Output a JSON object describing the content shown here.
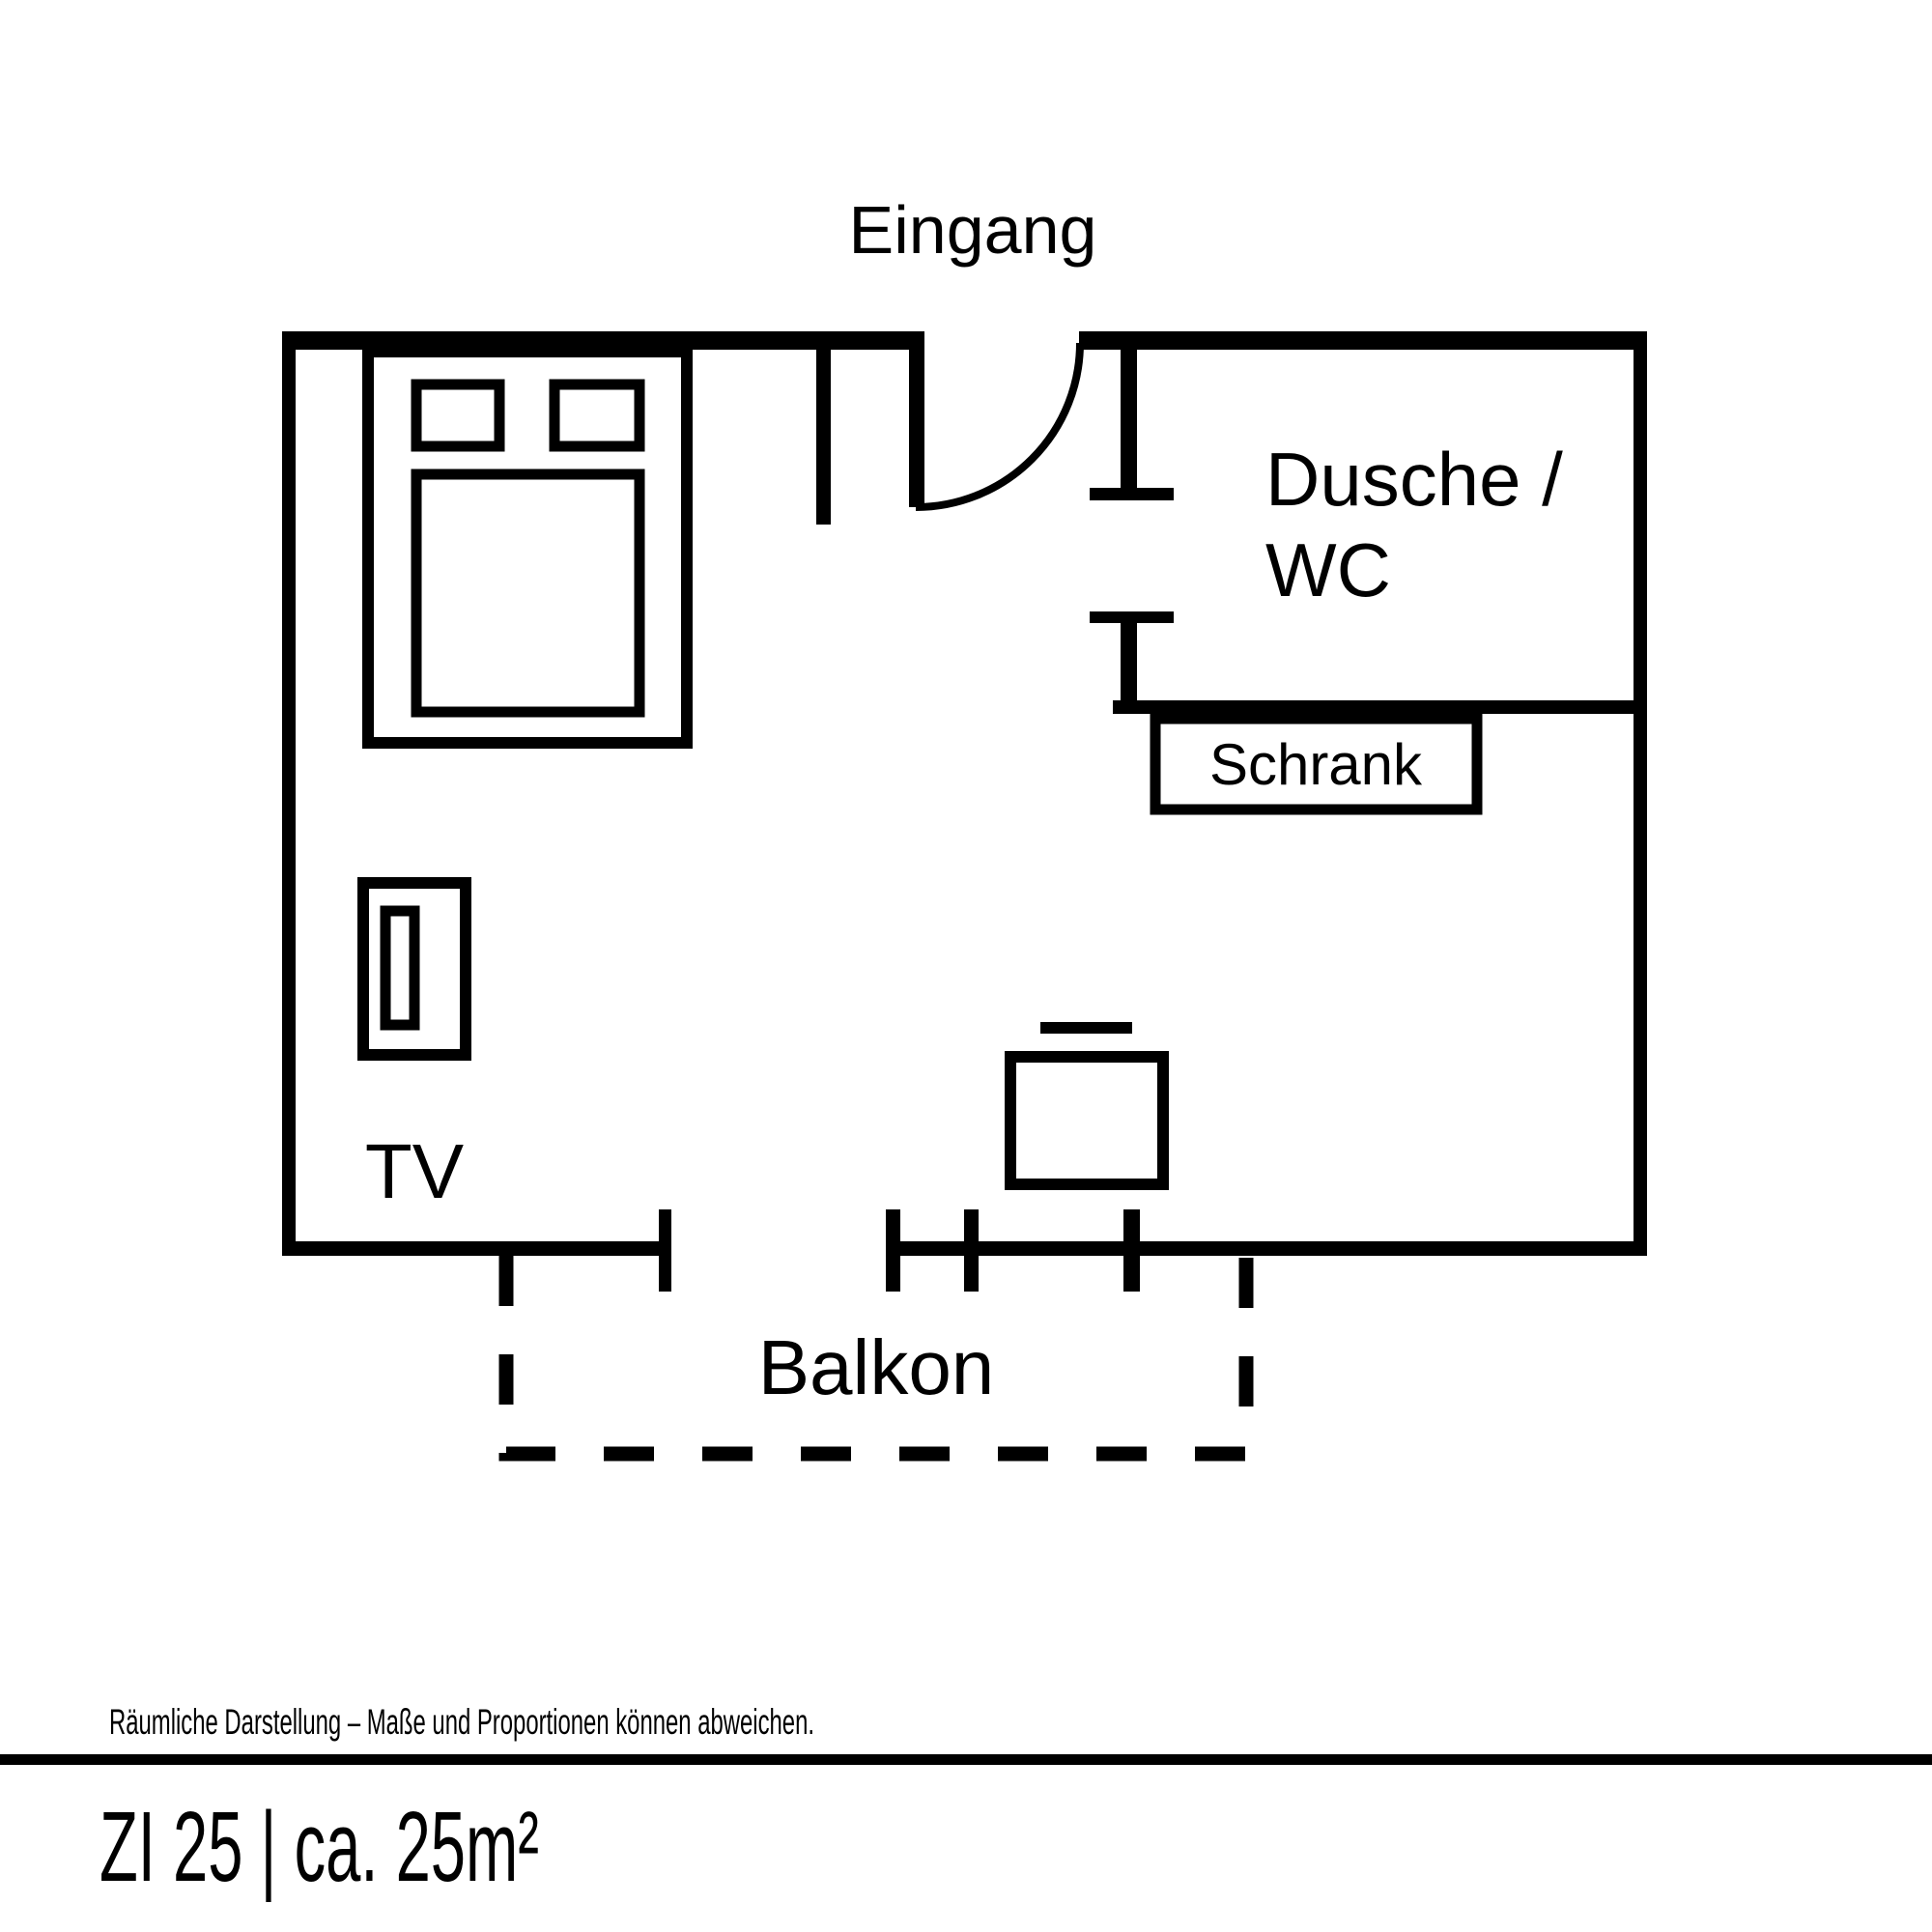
{
  "colors": {
    "background": "#ffffff",
    "lines": "#000000"
  },
  "floorplan": {
    "entrance_label": "Eingang",
    "bathroom_label_line1": "Dusche /",
    "bathroom_label_line2": "WC",
    "wardrobe_label": "Schrank",
    "tv_label": "TV",
    "balcony_label": "Balkon"
  },
  "footer": {
    "disclaimer": "Räumliche Darstellung – Maße und Proportionen können abweichen.",
    "room_title": "ZI 25 | ca. 25m²"
  }
}
